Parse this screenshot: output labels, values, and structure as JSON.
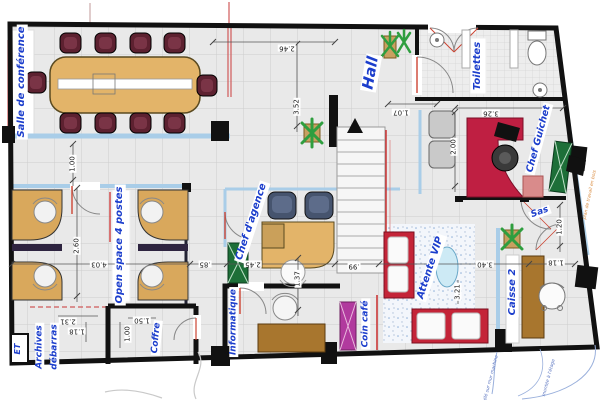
{
  "labels": {
    "salle_conference": "Salle de conférence",
    "hall": "Hall",
    "toilettes": "Toilettes",
    "chef_guichet": "Chef Guichet",
    "sas": "Sas",
    "open_space": "Open space 4 postes",
    "chef_agence": "Chef d'agence",
    "informatique": "Informatique",
    "archives": "Archives",
    "debarras": "débarras",
    "coffre": "Coffre",
    "et": "ET",
    "coin_cafe": "Coin café",
    "attente_vip": "Attente VIP",
    "caisse2": "Caisse 2"
  },
  "dims": {
    "d246": "2.46",
    "d352": "3.52",
    "d107": "1.07",
    "d326": "3.26",
    "d200": "2.00",
    "d120": "1.20",
    "d100a": "1.00",
    "d260": "2.60",
    "d403": "4.03",
    "d085": ".85",
    "d245": "2.45",
    "d099": ".99",
    "d137": "1.37",
    "d340": "3.40",
    "d321": "3.21",
    "d118r": "1.18",
    "d231": "2.31",
    "d118l": "1.18",
    "d150": "1.50",
    "d100b": "1.00"
  },
  "annotations": {
    "worktop": "plan de travail en bois",
    "wall_note": "télé sur mur machine",
    "stairs_note": "montée à l'étage"
  },
  "colors": {
    "label_blue": "#1c3ecc",
    "wall": "#111111",
    "glass": "#a9cde8",
    "red": "#c42438",
    "wood": "#e3b469",
    "wood_dark": "#a8762e",
    "chair_maroon": "#5d2130",
    "green": "#1d6f38",
    "magenta": "#b13a9e",
    "annotation_orange": "#d98a3d",
    "annotation_blue": "#5a74c0"
  }
}
